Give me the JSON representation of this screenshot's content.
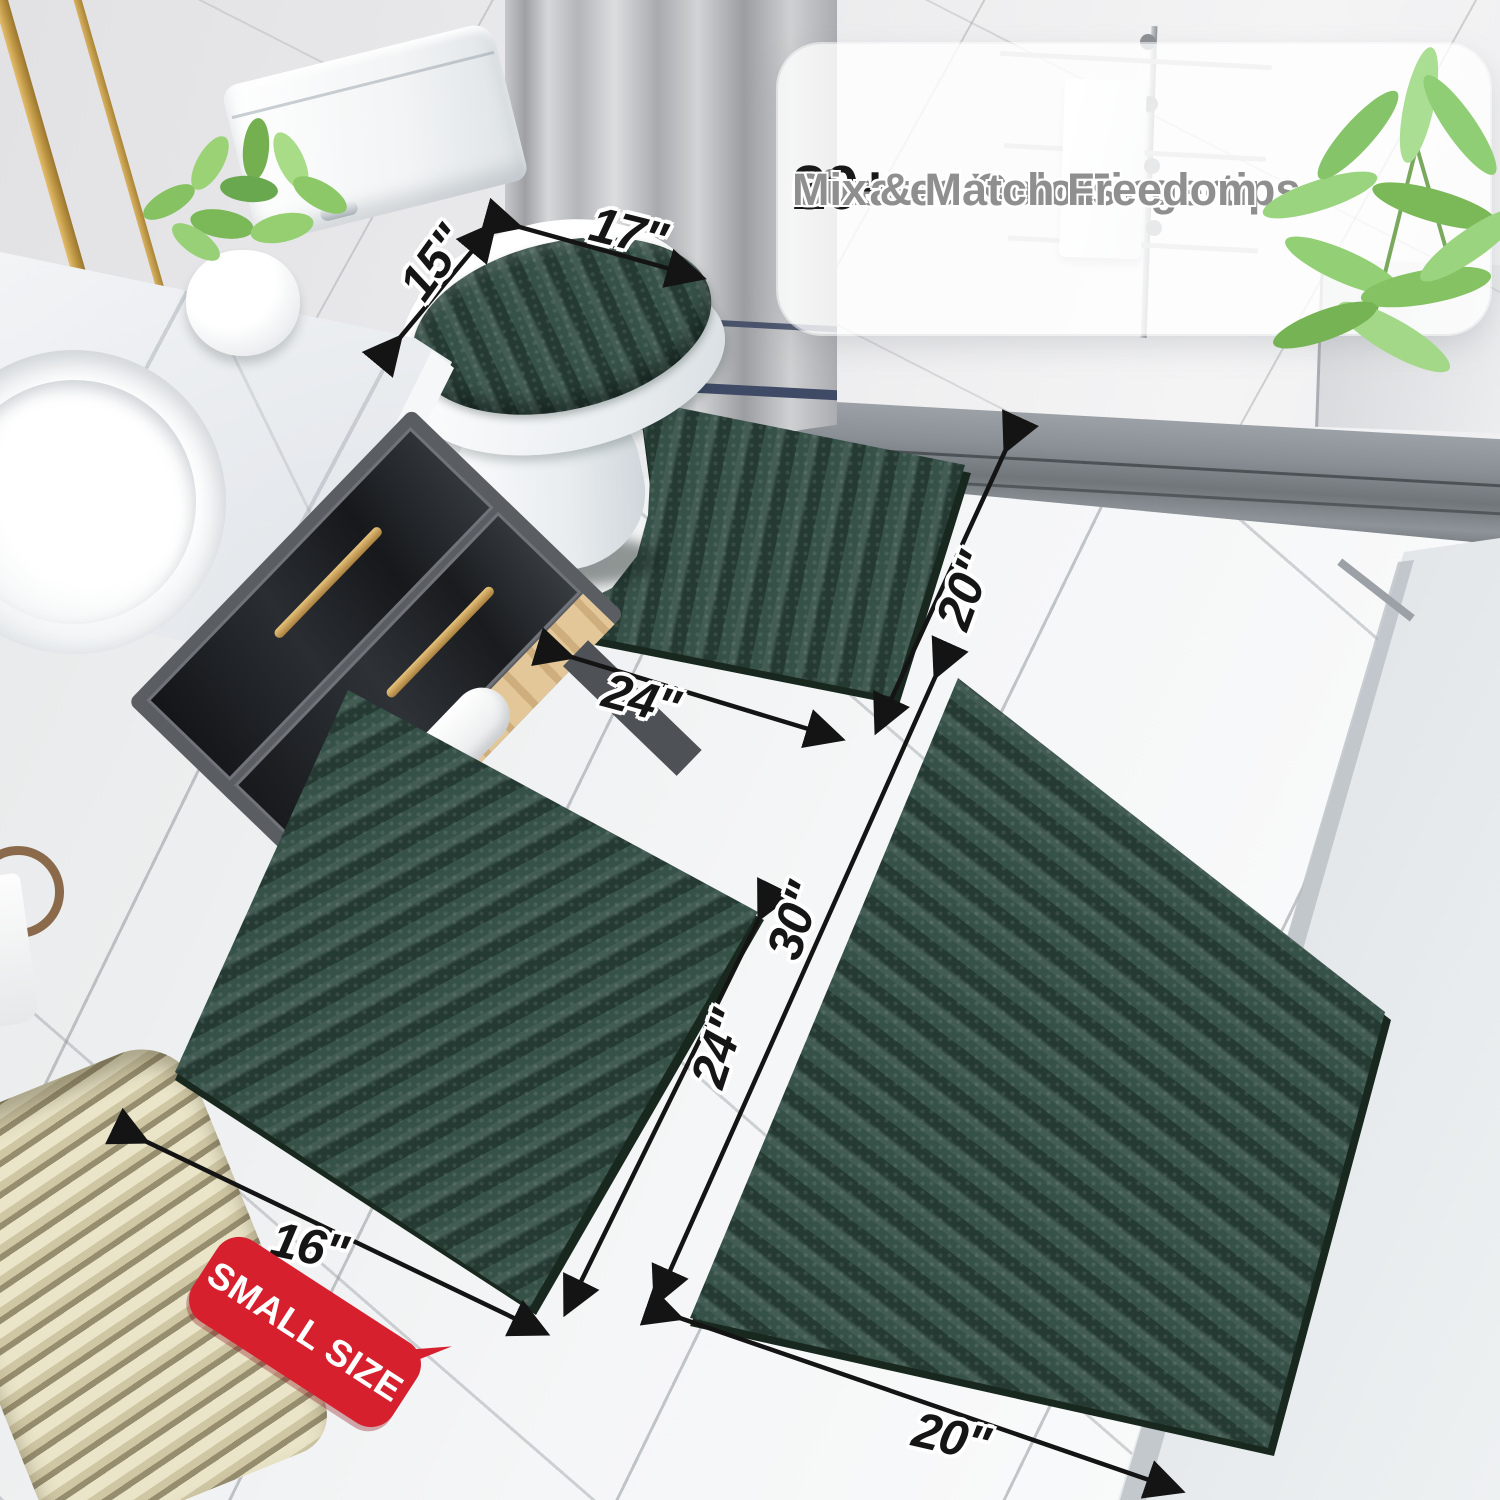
{
  "overlay_panel": {
    "checkmark": "✓",
    "features": [
      {
        "stat": "20+",
        "label": "Sizes at Your Fingertips"
      },
      {
        "stat": "30+",
        "label": "Curated Colors"
      },
      {
        "stat": "",
        "label": "Mix & Match Freedom"
      }
    ]
  },
  "measurements": {
    "lid_cover_depth": "15\"",
    "lid_cover_width": "17\"",
    "contour_rug_width": "24\"",
    "contour_rug_depth": "20\"",
    "small_rug_width": "16\"",
    "small_rug_length": "24\"",
    "large_rug_length": "30\"",
    "large_rug_width": "20\""
  },
  "badge": {
    "label": "SMALL SIZE"
  },
  "props": {
    "perfume_bottle_label": "MISQ"
  },
  "colors": {
    "rug_green": "#2e4a40",
    "badge_red": "#d7202e",
    "stat_black": "#191919",
    "feature_gray": "#8f8f8f",
    "gold_accent": "#c9a05a"
  }
}
